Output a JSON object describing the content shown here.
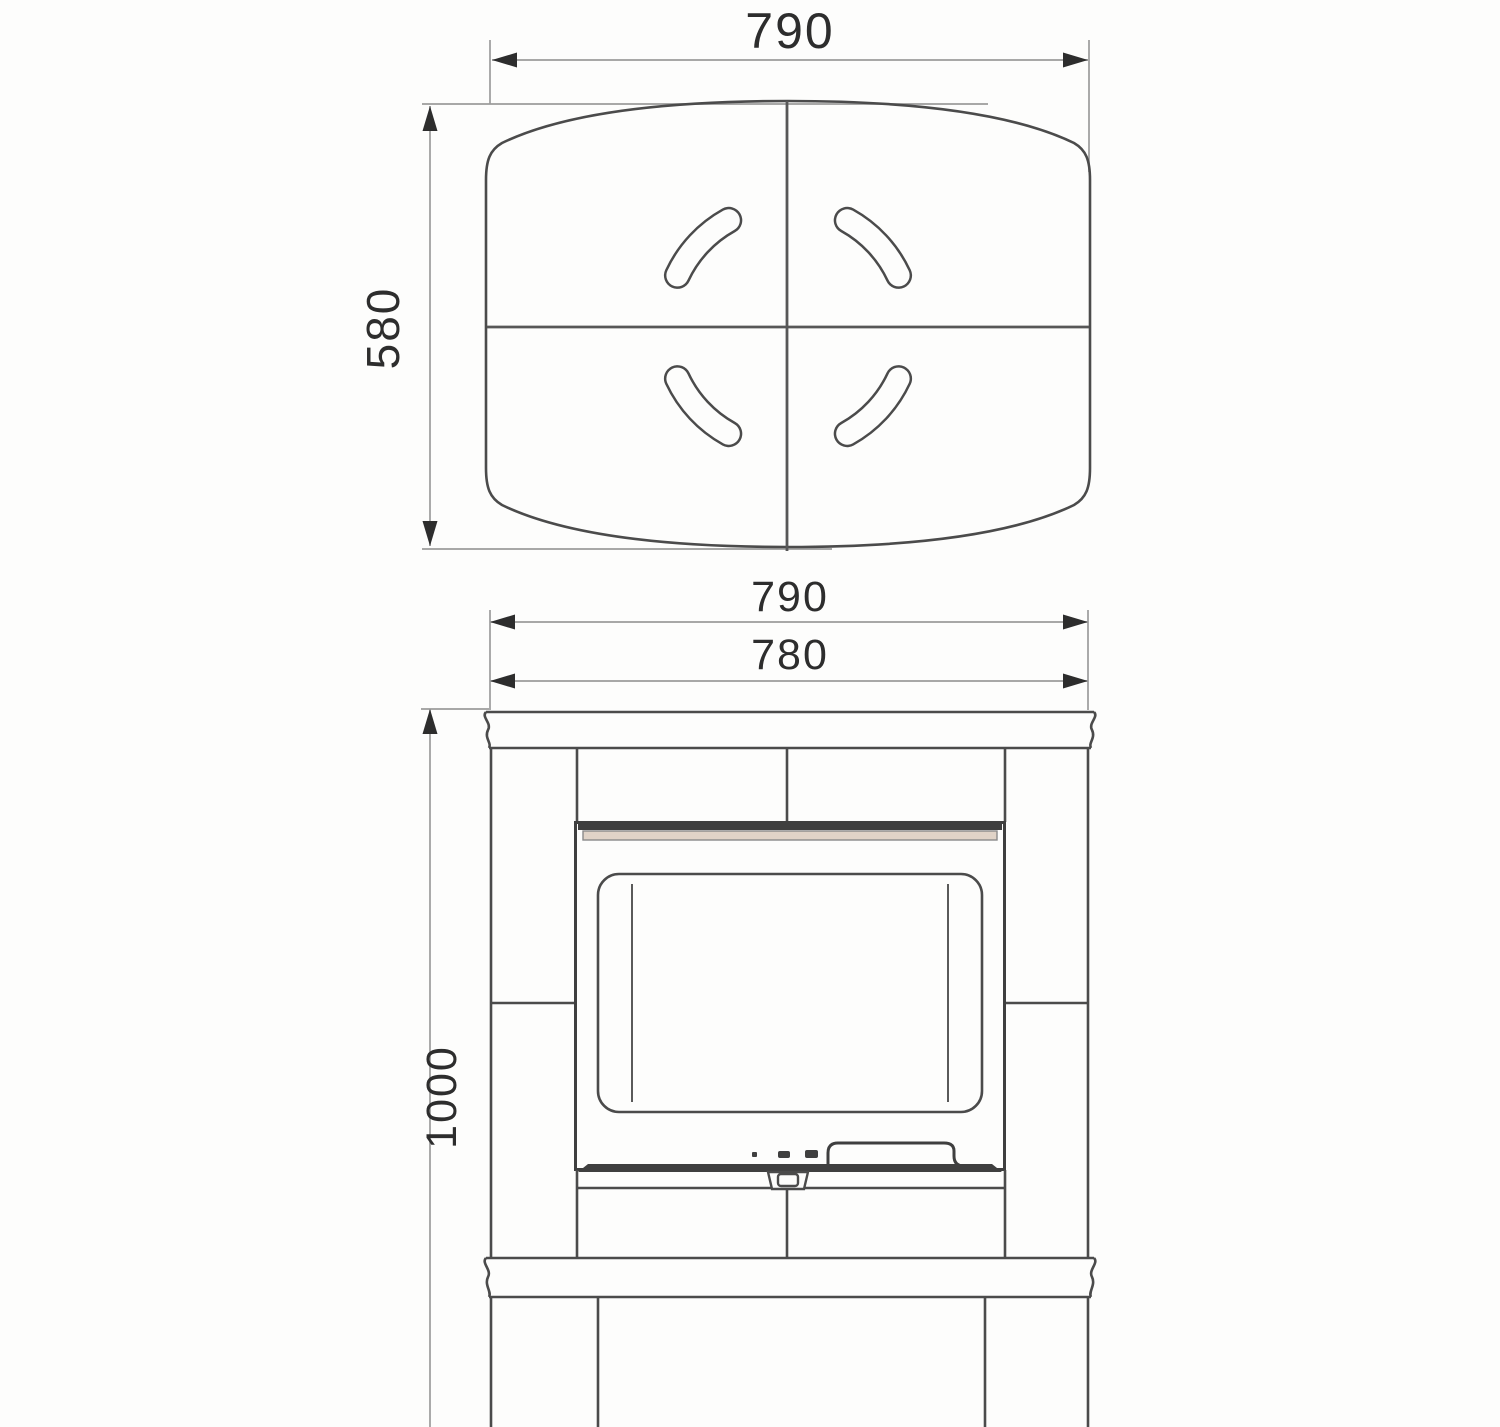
{
  "top_view": {
    "width_label": "790",
    "depth_label": "580"
  },
  "front_view": {
    "overall_width_label": "790",
    "body_width_label": "780",
    "height_label": "1000"
  },
  "colors": {
    "background": "#fdfdfc",
    "main_line": "#4b4b4b",
    "dark_line": "#3f3f3f",
    "dimension_line": "#9b9b9b",
    "dimension_text": "#2d2d2d",
    "door_gasket_band": "#e0d3c7"
  }
}
